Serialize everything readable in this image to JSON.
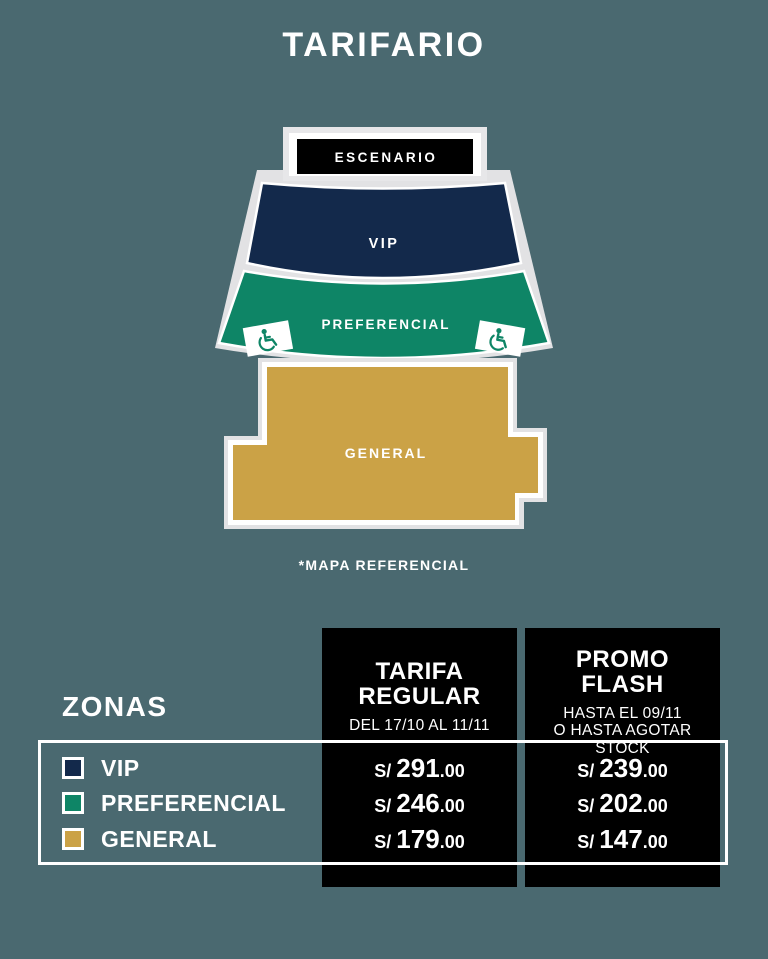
{
  "title": "TARIFARIO",
  "colors": {
    "background": "#4a6970",
    "vip": "#13294b",
    "preferencial": "#0e8566",
    "general": "#cba246",
    "table_black": "#000000",
    "white": "#ffffff",
    "outline_gray": "#e2e2e4"
  },
  "map": {
    "stage_label": "ESCENARIO",
    "vip_label": "VIP",
    "preferencial_label": "PREFERENCIAL",
    "general_label": "GENERAL",
    "note": "*MAPA REFERENCIAL"
  },
  "table": {
    "zones_label": "ZONAS",
    "columns": [
      {
        "title_line1": "TARIFA",
        "title_line2": "REGULAR",
        "subtitle_line1": "DEL 17/10 AL 11/11"
      },
      {
        "title_line1": "PROMO",
        "title_line2": "FLASH",
        "subtitle_line1": "HASTA EL 09/11",
        "subtitle_line2": "O HASTA AGOTAR STOCK"
      }
    ],
    "rows": [
      {
        "zone": "VIP",
        "color": "#13294b",
        "regular": {
          "cur": "S/",
          "int": "291",
          "dec": ".00"
        },
        "promo": {
          "cur": "S/",
          "int": "239",
          "dec": ".00"
        }
      },
      {
        "zone": "PREFERENCIAL",
        "color": "#0e8566",
        "regular": {
          "cur": "S/",
          "int": "246",
          "dec": ".00"
        },
        "promo": {
          "cur": "S/",
          "int": "202",
          "dec": ".00"
        }
      },
      {
        "zone": "GENERAL",
        "color": "#cba246",
        "regular": {
          "cur": "S/",
          "int": "179",
          "dec": ".00"
        },
        "promo": {
          "cur": "S/",
          "int": "147",
          "dec": ".00"
        }
      }
    ]
  }
}
